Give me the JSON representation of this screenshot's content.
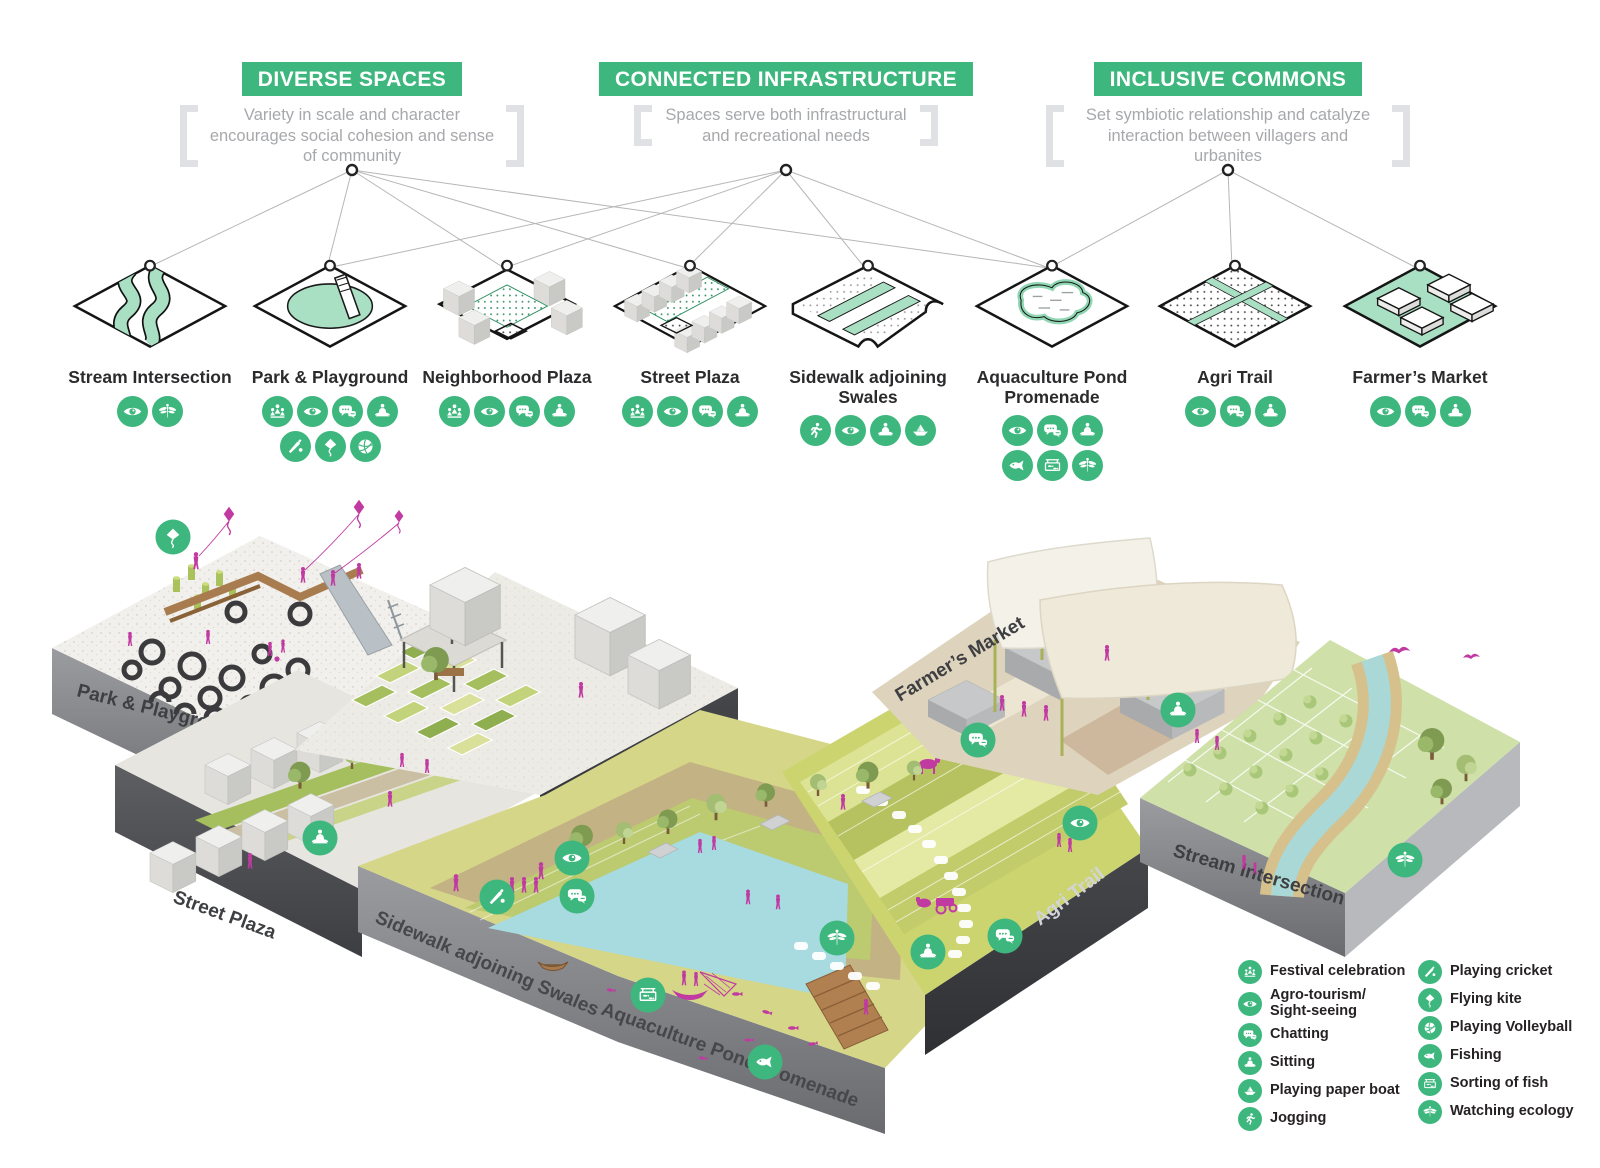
{
  "colors": {
    "accent_green": "#3db77d",
    "mint_green": "#a9dfc3",
    "magenta": "#c03aa2",
    "pond_blue": "#a7dbe0"
  },
  "principles": [
    {
      "title": "DIVERSE SPACES",
      "description": "Variety in scale and character encourages social cohesion and sense of community"
    },
    {
      "title": "CONNECTED INFRASTRUCTURE",
      "description": "Spaces serve both infrastructural and recreational needs"
    },
    {
      "title": "INCLUSIVE COMMONS",
      "description": "Set symbiotic relationship and catalyze interaction between villagers and urbanites"
    }
  ],
  "tiles": [
    {
      "label": "Stream Intersection",
      "icons": [
        "sightseeing",
        "ecology"
      ]
    },
    {
      "label": "Park & Playground",
      "icons": [
        "festival",
        "sightseeing",
        "chatting",
        "sitting",
        "cricket",
        "kite",
        "volleyball"
      ]
    },
    {
      "label": "Neighborhood Plaza",
      "icons": [
        "festival",
        "sightseeing",
        "chatting",
        "sitting"
      ]
    },
    {
      "label": "Street Plaza",
      "icons": [
        "festival",
        "sightseeing",
        "chatting",
        "sitting"
      ]
    },
    {
      "label": "Sidewalk adjoining Swales",
      "icons": [
        "jogging",
        "sightseeing",
        "sitting",
        "paperboat"
      ]
    },
    {
      "label": "Aquaculture Pond Promenade",
      "icons": [
        "sightseeing",
        "chatting",
        "sitting",
        "fishing",
        "sorting",
        "ecology"
      ]
    },
    {
      "label": "Agri Trail",
      "icons": [
        "sightseeing",
        "chatting",
        "sitting"
      ]
    },
    {
      "label": "Farmer’s Market",
      "icons": [
        "sightseeing",
        "chatting",
        "sitting"
      ]
    }
  ],
  "map": {
    "labels": {
      "park": "Park & Playground",
      "street": "Street Plaza",
      "neighborhood": "Neighborhood Plaza",
      "sidewalk": "Sidewalk adjoining Swales",
      "pond": "Aquaculture Pond Promenade",
      "market": "Farmer’s Market",
      "agri": "Agri Trail",
      "stream": "Stream Intersection"
    },
    "badges": [
      {
        "icon": "kite",
        "x": 173,
        "y": 537
      },
      {
        "icon": "sitting",
        "x": 320,
        "y": 838
      },
      {
        "icon": "sightseeing",
        "x": 572,
        "y": 858
      },
      {
        "icon": "chatting",
        "x": 577,
        "y": 896
      },
      {
        "icon": "cricket",
        "x": 497,
        "y": 897
      },
      {
        "icon": "sorting",
        "x": 648,
        "y": 995
      },
      {
        "icon": "fishing",
        "x": 765,
        "y": 1062
      },
      {
        "icon": "ecology",
        "x": 837,
        "y": 938
      },
      {
        "icon": "sitting",
        "x": 928,
        "y": 952
      },
      {
        "icon": "chatting",
        "x": 1005,
        "y": 936
      },
      {
        "icon": "chatting",
        "x": 978,
        "y": 740
      },
      {
        "icon": "sitting",
        "x": 1178,
        "y": 710
      },
      {
        "icon": "sightseeing",
        "x": 1080,
        "y": 823
      },
      {
        "icon": "ecology",
        "x": 1405,
        "y": 860
      }
    ]
  },
  "legend": {
    "left": [
      {
        "icon": "festival",
        "label": "Festival celebration"
      },
      {
        "icon": "sightseeing",
        "label": "Agro-tourism/ Sight-seeing"
      },
      {
        "icon": "chatting",
        "label": "Chatting"
      },
      {
        "icon": "sitting",
        "label": "Sitting"
      },
      {
        "icon": "paperboat",
        "label": "Playing paper boat"
      },
      {
        "icon": "jogging",
        "label": "Jogging"
      }
    ],
    "right": [
      {
        "icon": "cricket",
        "label": "Playing cricket"
      },
      {
        "icon": "kite",
        "label": "Flying kite"
      },
      {
        "icon": "volleyball",
        "label": "Playing Volleyball"
      },
      {
        "icon": "fishing",
        "label": "Fishing"
      },
      {
        "icon": "sorting",
        "label": "Sorting of fish"
      },
      {
        "icon": "ecology",
        "label": "Watching ecology"
      }
    ]
  }
}
